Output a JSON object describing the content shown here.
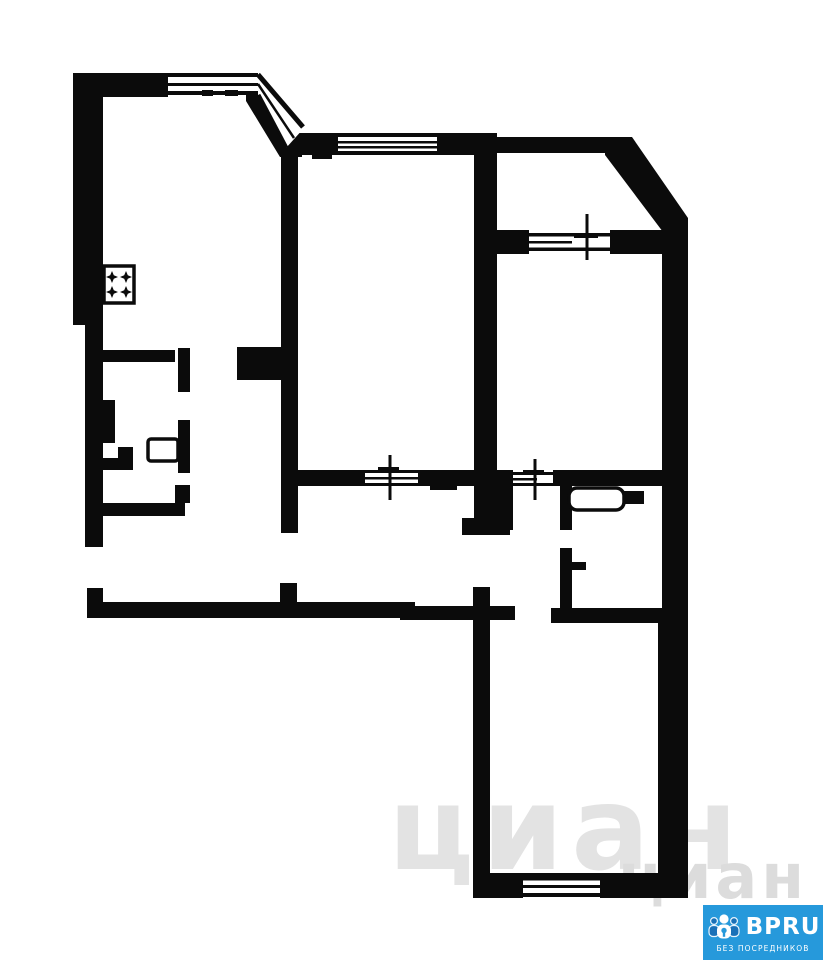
{
  "canvas": {
    "width": 823,
    "height": 960,
    "background_color": "#ffffff"
  },
  "floor_plan": {
    "wall_color": "#0b0b0b",
    "room_fill": "#ffffff",
    "symbols": {
      "stove_burners": 4,
      "windows": 6,
      "vent_crosses": 3
    }
  },
  "watermark": {
    "text": "циан",
    "color": "#e3e3e3"
  },
  "logo": {
    "brand": "BPRU",
    "tagline": "БЕЗ ПОСРЕДНИКОВ",
    "background_color": "#2699db",
    "text_color": "#ffffff",
    "icon": "people-group-keyhole-icon"
  }
}
